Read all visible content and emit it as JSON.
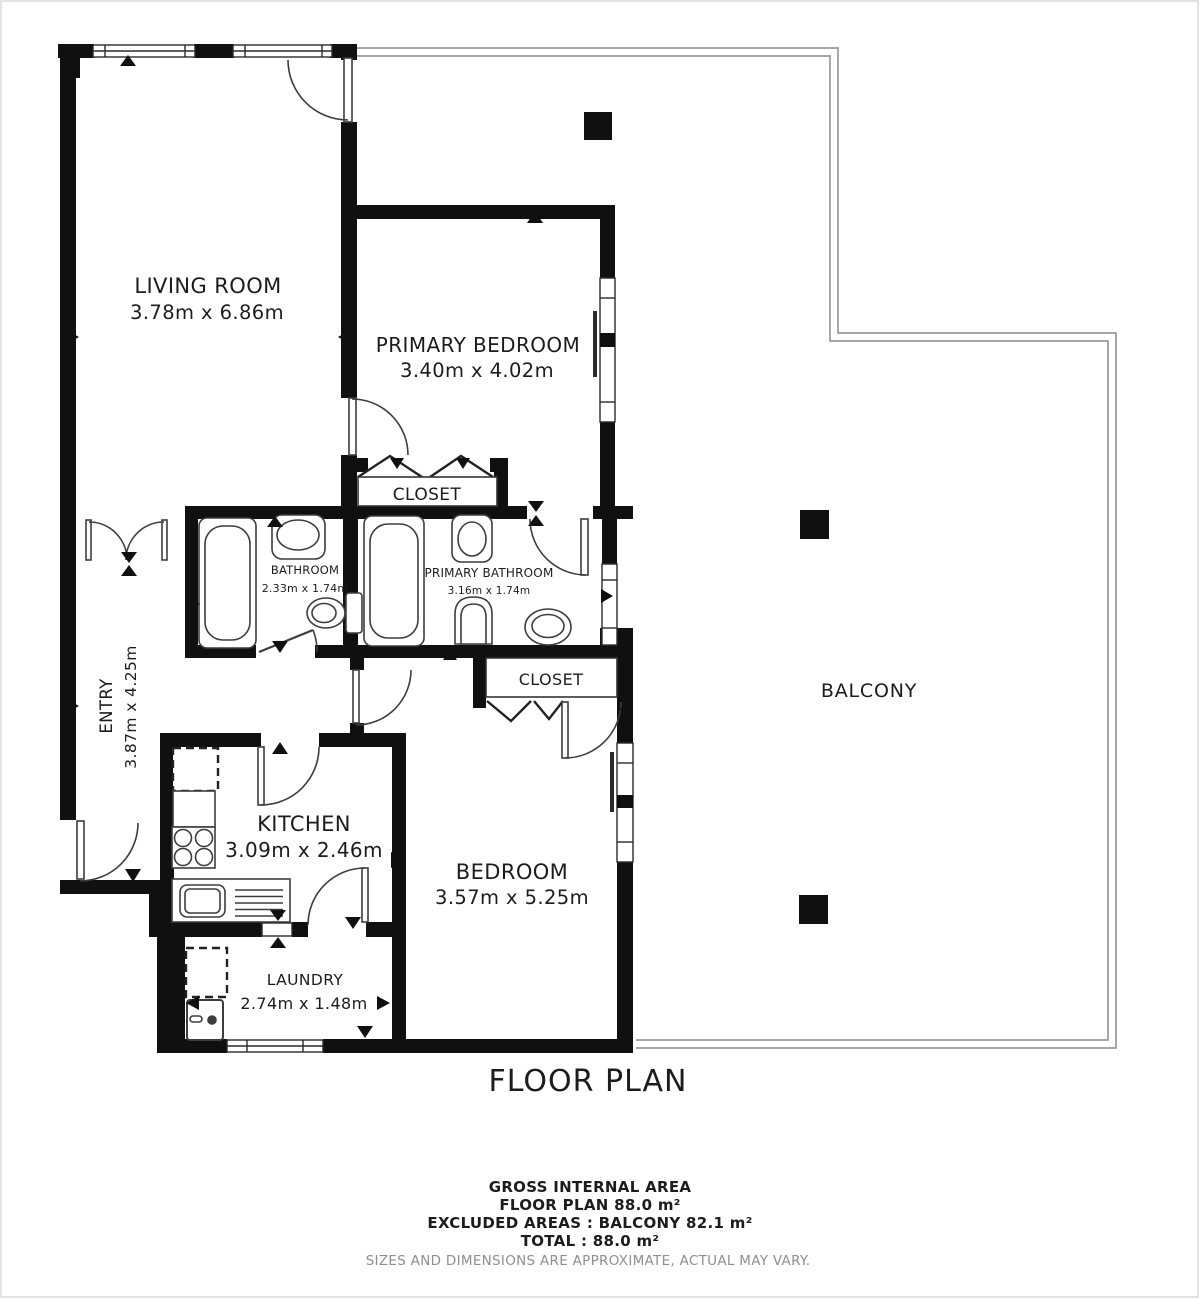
{
  "title": "FLOOR PLAN",
  "rooms": {
    "living_room": {
      "name": "LIVING ROOM",
      "dims": "3.78m x 6.86m"
    },
    "primary_bedroom": {
      "name": "PRIMARY BEDROOM",
      "dims": "3.40m x 4.02m"
    },
    "primary_closet": {
      "name": "CLOSET"
    },
    "bathroom": {
      "name": "BATHROOM",
      "dims": "2.33m x 1.74m"
    },
    "primary_bathroom": {
      "name": "PRIMARY BATHROOM",
      "dims": "3.16m x 1.74m"
    },
    "entry": {
      "name": "ENTRY",
      "dims": "3.87m x 4.25m"
    },
    "kitchen": {
      "name": "KITCHEN",
      "dims": "3.09m x 2.46m"
    },
    "bedroom": {
      "name": "BEDROOM",
      "dims": "3.57m x 5.25m"
    },
    "bedroom_closet": {
      "name": "CLOSET"
    },
    "laundry": {
      "name": "LAUNDRY",
      "dims": "2.74m x 1.48m"
    },
    "balcony": {
      "name": "BALCONY"
    }
  },
  "footer": {
    "line1": "GROSS INTERNAL AREA",
    "line2": "FLOOR PLAN 88.0 m²",
    "line3": "EXCLUDED AREAS :  BALCONY 82.1 m²",
    "line4": "TOTAL :  88.0 m²",
    "disclaimer": "SIZES AND DIMENSIONS ARE APPROXIMATE, ACTUAL MAY VARY."
  },
  "colors": {
    "wall": "#101010",
    "fixture": "#3d3d3d",
    "balcony_line": "#9a9a9a",
    "text": "#1c1c1c",
    "muted": "#8f8f8f"
  }
}
